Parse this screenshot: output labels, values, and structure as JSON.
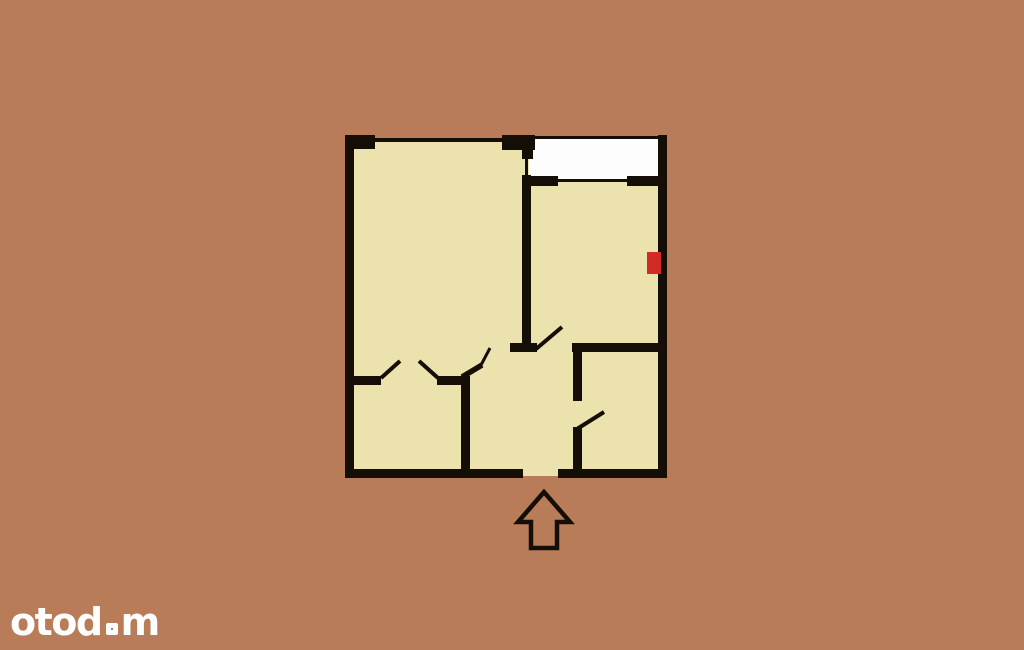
{
  "image": {
    "kind": "real-estate floor plan",
    "rooms_visible": 4,
    "features": [
      "balcony",
      "entrance-arrow",
      "door-swings",
      "red-wall-marker"
    ]
  },
  "colors": {
    "background": "#b97c58",
    "floor": "#ebe2ae",
    "wall": "#150e07",
    "balcony_fill": "#fdfdfd",
    "marker_red": "#d02b24",
    "logo": "#ffffff"
  },
  "watermark": {
    "brand": "otodom",
    "prefix": "otod",
    "suffix": "m"
  },
  "icons": {
    "entrance_arrow": "up-block-arrow-outline",
    "logo_square": "square-outline"
  }
}
